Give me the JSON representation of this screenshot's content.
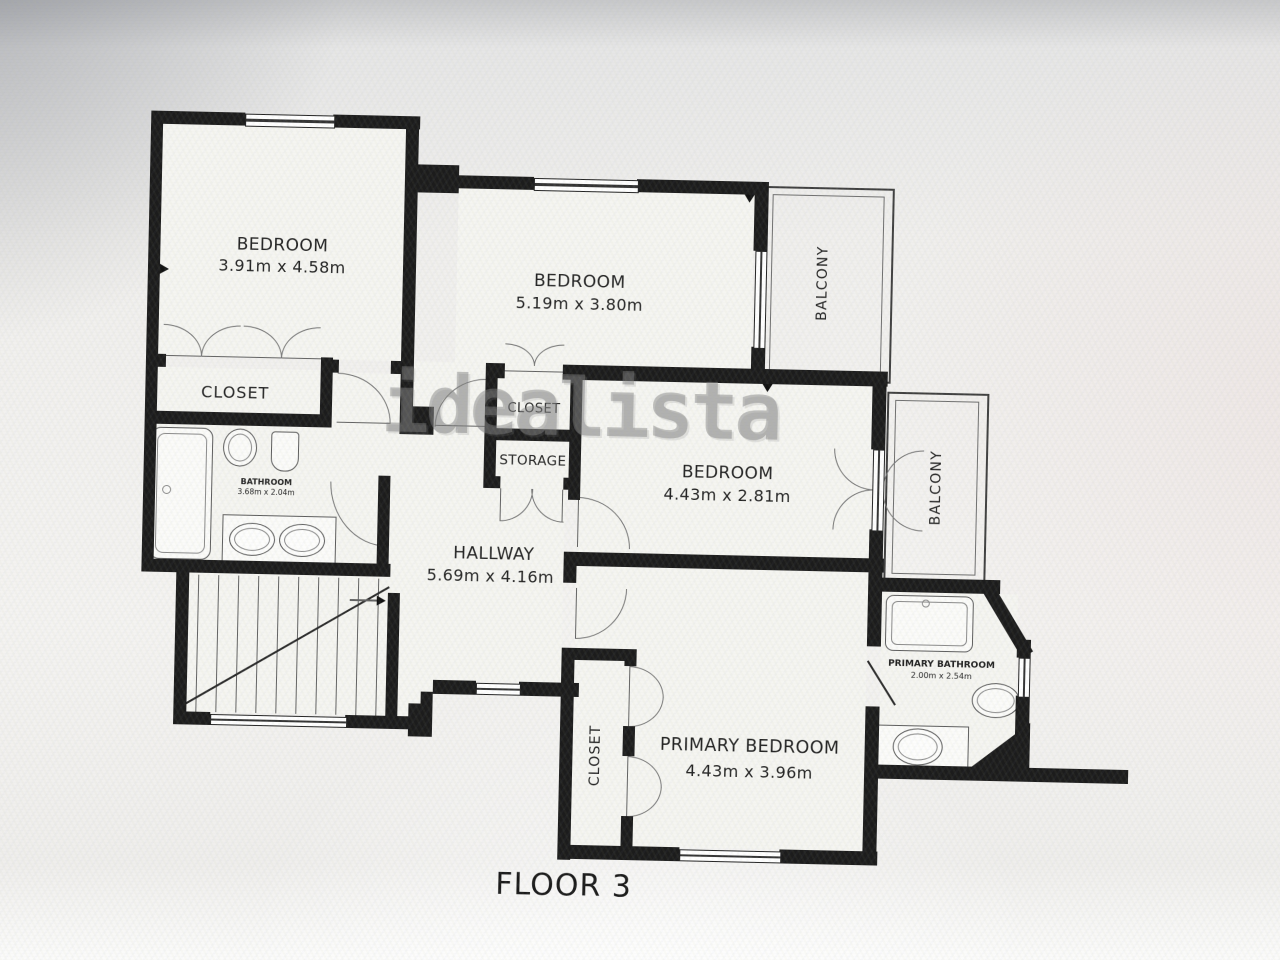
{
  "photo": {
    "watermark": "idealista",
    "floor_label": "FLOOR 3"
  },
  "rooms": {
    "bedroom_top_left": {
      "label": "BEDROOM",
      "dims": "3.91m x 4.58m"
    },
    "bedroom_top_middle": {
      "label": "BEDROOM",
      "dims": "5.19m x 3.80m"
    },
    "bedroom_middle_right": {
      "label": "BEDROOM",
      "dims": "4.43m x 2.81m"
    },
    "primary_bedroom": {
      "label": "PRIMARY BEDROOM",
      "dims": "4.43m x 3.96m"
    },
    "hallway": {
      "label": "HALLWAY",
      "dims": "5.69m x 4.16m"
    },
    "bathroom": {
      "label": "BATHROOM",
      "dims": "3.68m x 2.04m"
    },
    "primary_bathroom": {
      "label": "PRIMARY BATHROOM",
      "dims": "2.00m x 2.54m"
    },
    "closet_bedroom1": {
      "label": "CLOSET"
    },
    "closet_hall": {
      "label": "CLOSET"
    },
    "storage": {
      "label": "STORAGE"
    },
    "closet_primary": {
      "label": "CLOSET"
    },
    "balcony_top": {
      "label": "BALCONY"
    },
    "balcony_right": {
      "label": "BALCONY"
    }
  },
  "colors": {
    "wall": "#1c1c1c",
    "fixture_line": "#666666",
    "room_fill": "#f5f5f1",
    "label_text": "#222222",
    "watermark_gray": "#8a8a8a"
  }
}
